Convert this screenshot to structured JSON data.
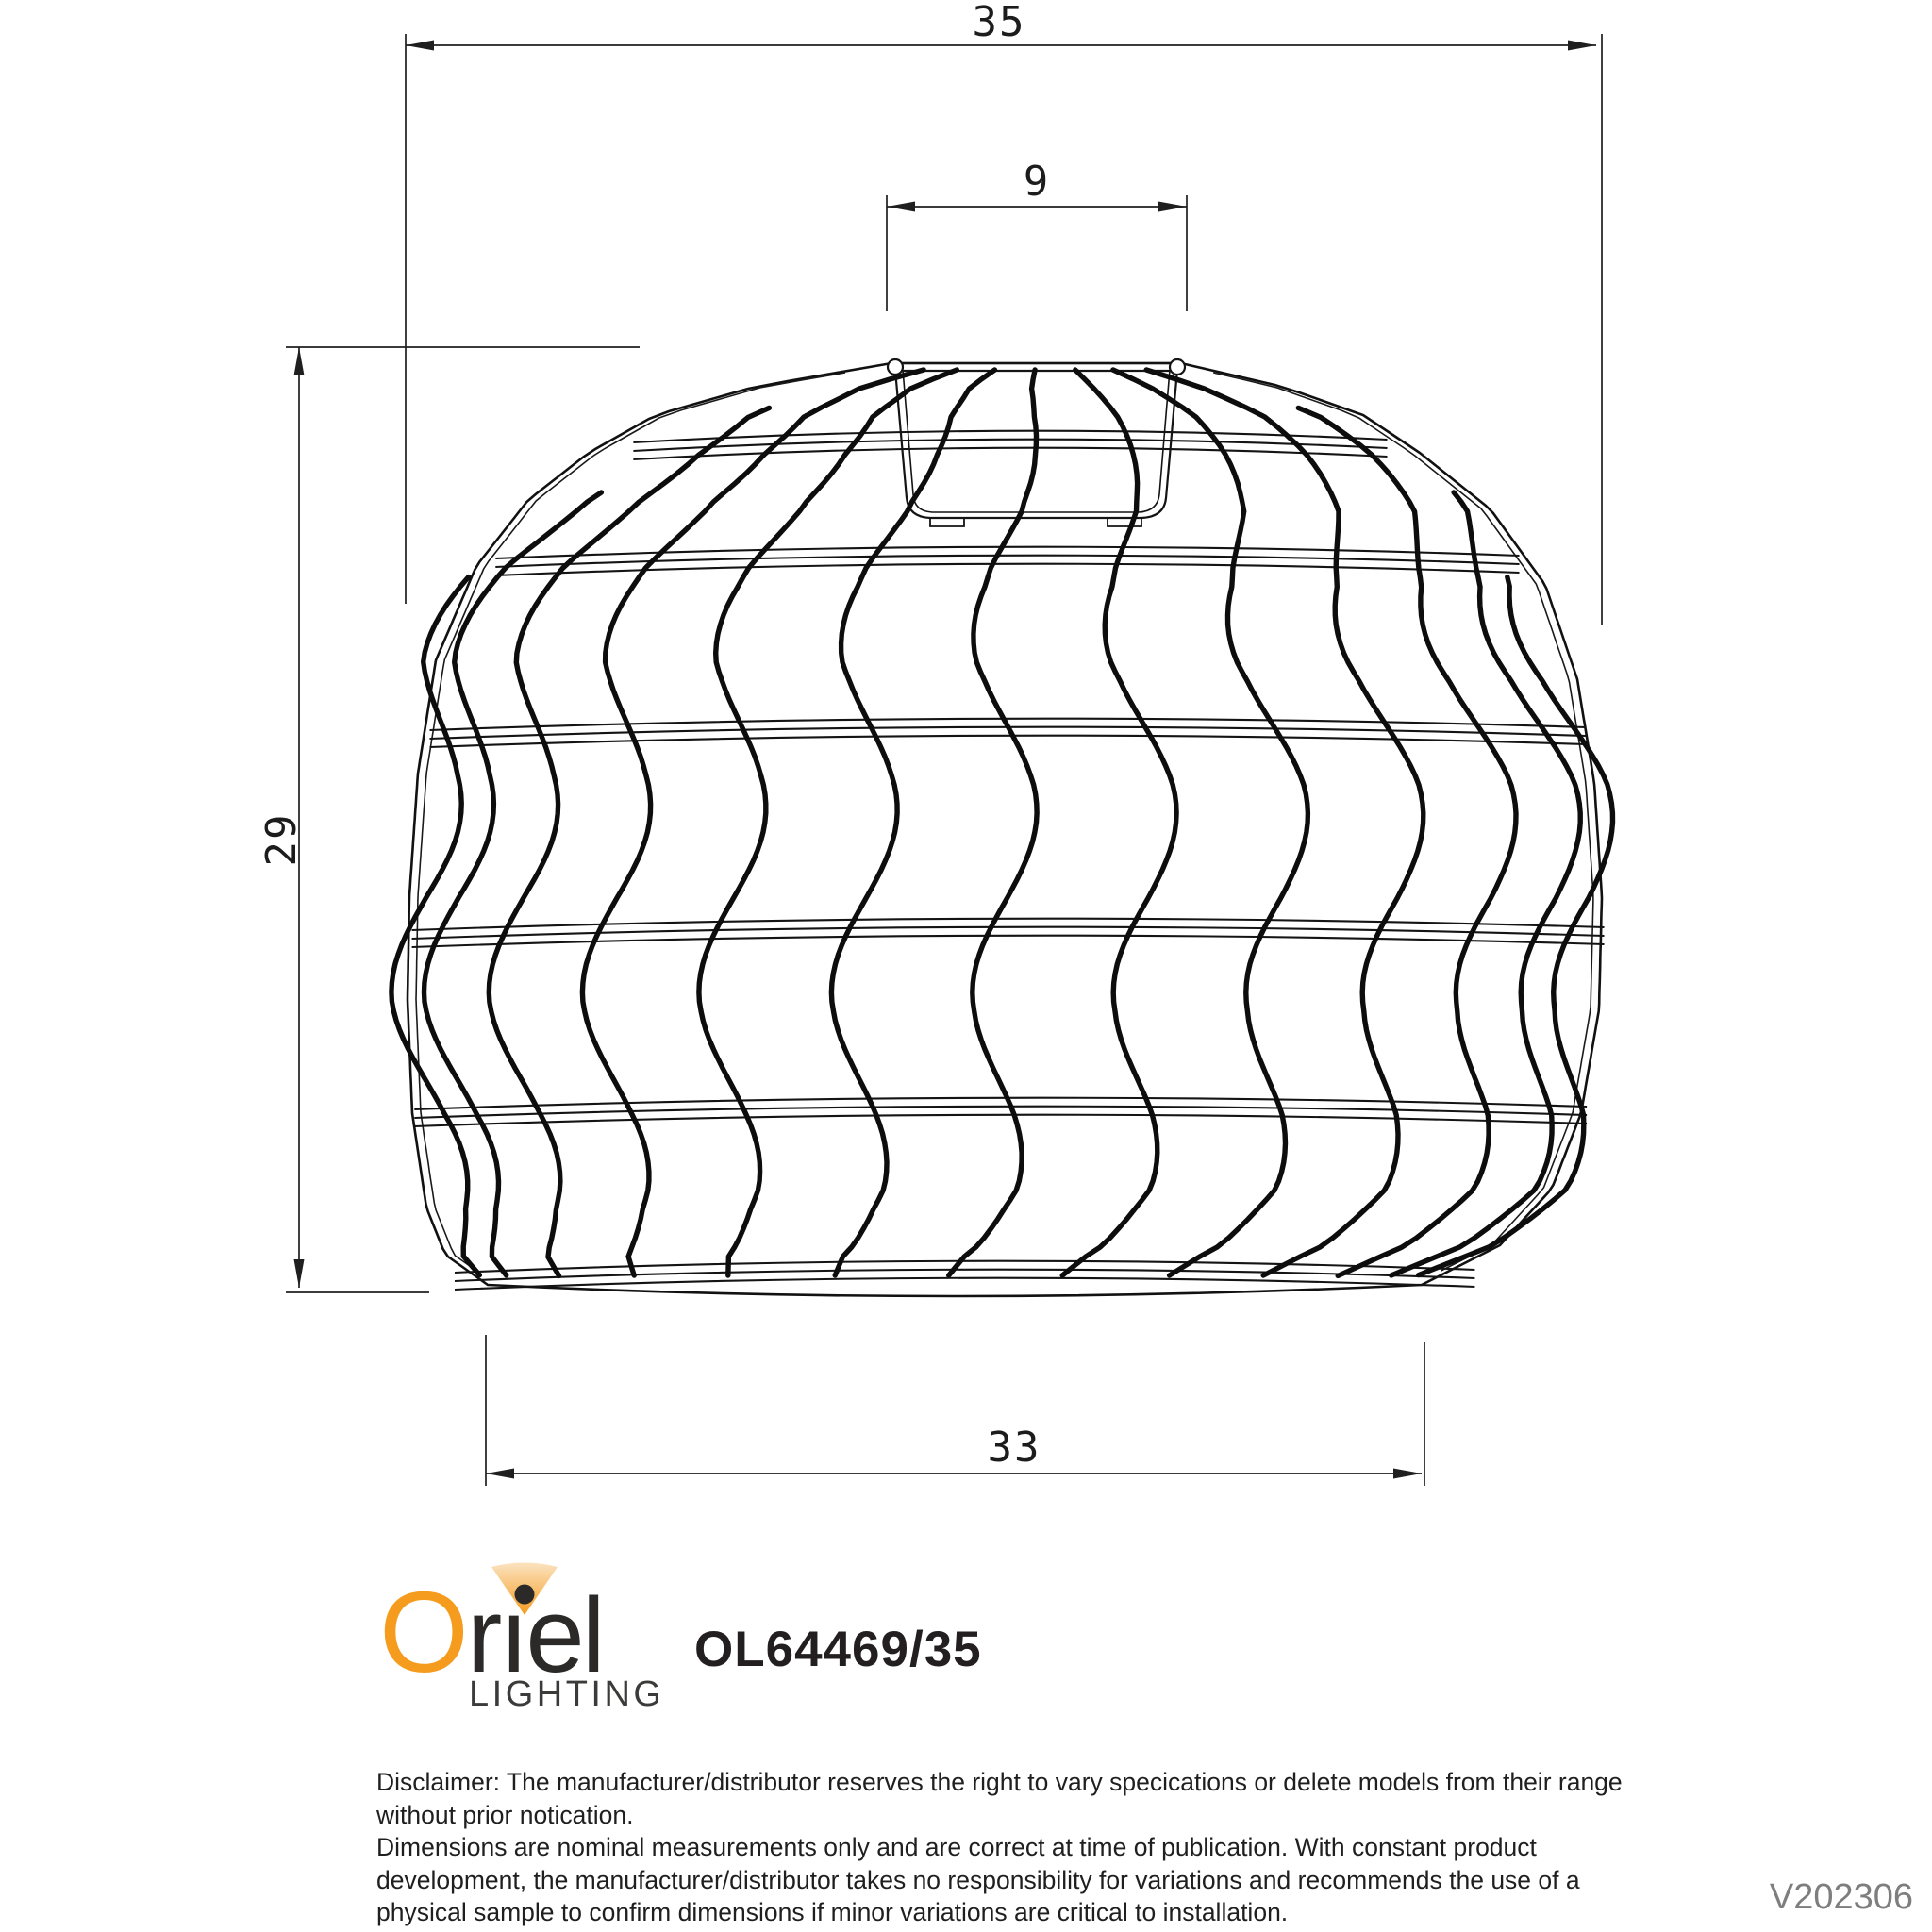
{
  "page_title": "Oriel Lighting shade dimension drawing",
  "drawing": {
    "dim_width_max": "35",
    "dim_top_opening": "9",
    "dim_height": "29",
    "dim_width_bottom": "33"
  },
  "branding": {
    "brand": "Oriel",
    "brand_first_letter": "O",
    "brand_rest": "rıel",
    "tagline": "LIGHTING",
    "product_code": "OL64469/35"
  },
  "disclaimer": {
    "lines": [
      "Disclaimer: The manufacturer/distributor reserves the right to vary specications or delete models from their range",
      "without prior notication.",
      "Dimensions are nominal measurements only and are correct at time of publication. With constant product",
      "development, the manufacturer/distributor takes no responsibility for variations and recommends the use of a",
      "physical sample to confirm dimensions if minor variations are critical to installation."
    ]
  },
  "version": "V202306",
  "colors": {
    "accent_orange": "#F59C1F",
    "ink": "#231F20",
    "line_black": "#141414",
    "muted_gray": "#7E7E7E"
  }
}
